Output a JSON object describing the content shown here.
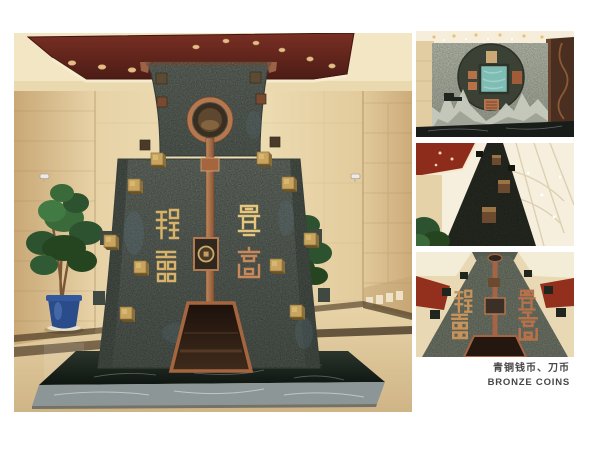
{
  "caption": {
    "line1": "青铜钱币、刀币",
    "line2": "BRONZE COINS"
  },
  "photos": {
    "main": {
      "alt": "Lobby with large bronze spade-coin monument: grey stone body, copper ring hole, copper center strip, gilded seal-script characters, trapezoid niche, black marble platform, two potted plants, dark red ceiling with downlights, beige travertine walls"
    },
    "thumb_top": {
      "alt": "Wall relief with round bronze coin, square jade center, bronze plaques and carved stone mountains over a black marble ledge"
    },
    "thumb_middle": {
      "alt": "Upward view of the monument edge with bronze cube studs against a bright atrium ceiling and red panel"
    },
    "thumb_bottom": {
      "alt": "Upward view of the monument face with gilded characters, copper strip and niche, red ceiling panels behind"
    }
  },
  "colors": {
    "page_bg": "#ffffff",
    "caption_text": "#474747",
    "ceiling_red": "#63241d",
    "wall_beige": "#e8d3a8",
    "stone_grey": "#5c645c",
    "copper": "#a5663f",
    "gold": "#c9a45f",
    "marble_dark": "#161d18",
    "pot_blue": "#2a4c8a"
  }
}
